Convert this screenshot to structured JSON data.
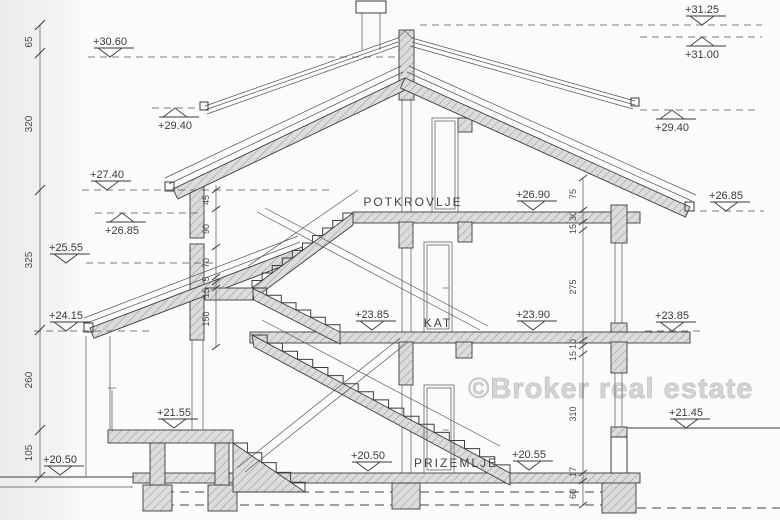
{
  "watermark": "©Broker real estate",
  "rooms": {
    "attic": "POTKROVLJE",
    "first_floor": "KAT",
    "ground_floor": "PRIZEMLJE"
  },
  "levels": {
    "l3125": "+31.25",
    "l3100": "+31.00",
    "l3060": "+30.60",
    "l2940_left": "+29.40",
    "l2940_right": "+29.40",
    "l2740": "+27.40",
    "l2685_left": "+26.85",
    "l2685_right": "+26.85",
    "l2690": "+26.90",
    "l2555": "+25.55",
    "l2415": "+24.15",
    "l2390": "+23.90",
    "l2385_center": "+23.85",
    "l2385_right": "+23.85",
    "l2155": "+21.55",
    "l2145": "+21.45",
    "l2050_left": "+20.50",
    "l2050_center": "+20.50",
    "l2055": "+20.55"
  },
  "dimensions": {
    "left_ruler": [
      "65",
      "320",
      "325",
      "260",
      "105"
    ],
    "mid_chain": [
      "45",
      "90",
      "70",
      "5",
      "15",
      "150"
    ],
    "right_chain": [
      "75",
      "30",
      "15",
      "275",
      "10",
      "15",
      "310",
      "17",
      "60"
    ]
  },
  "colors": {
    "line": "#3c3c3c",
    "wall_fill": "#d9d9d9",
    "watermark": "#d2d2d0",
    "paper": "#fbfbf9"
  }
}
